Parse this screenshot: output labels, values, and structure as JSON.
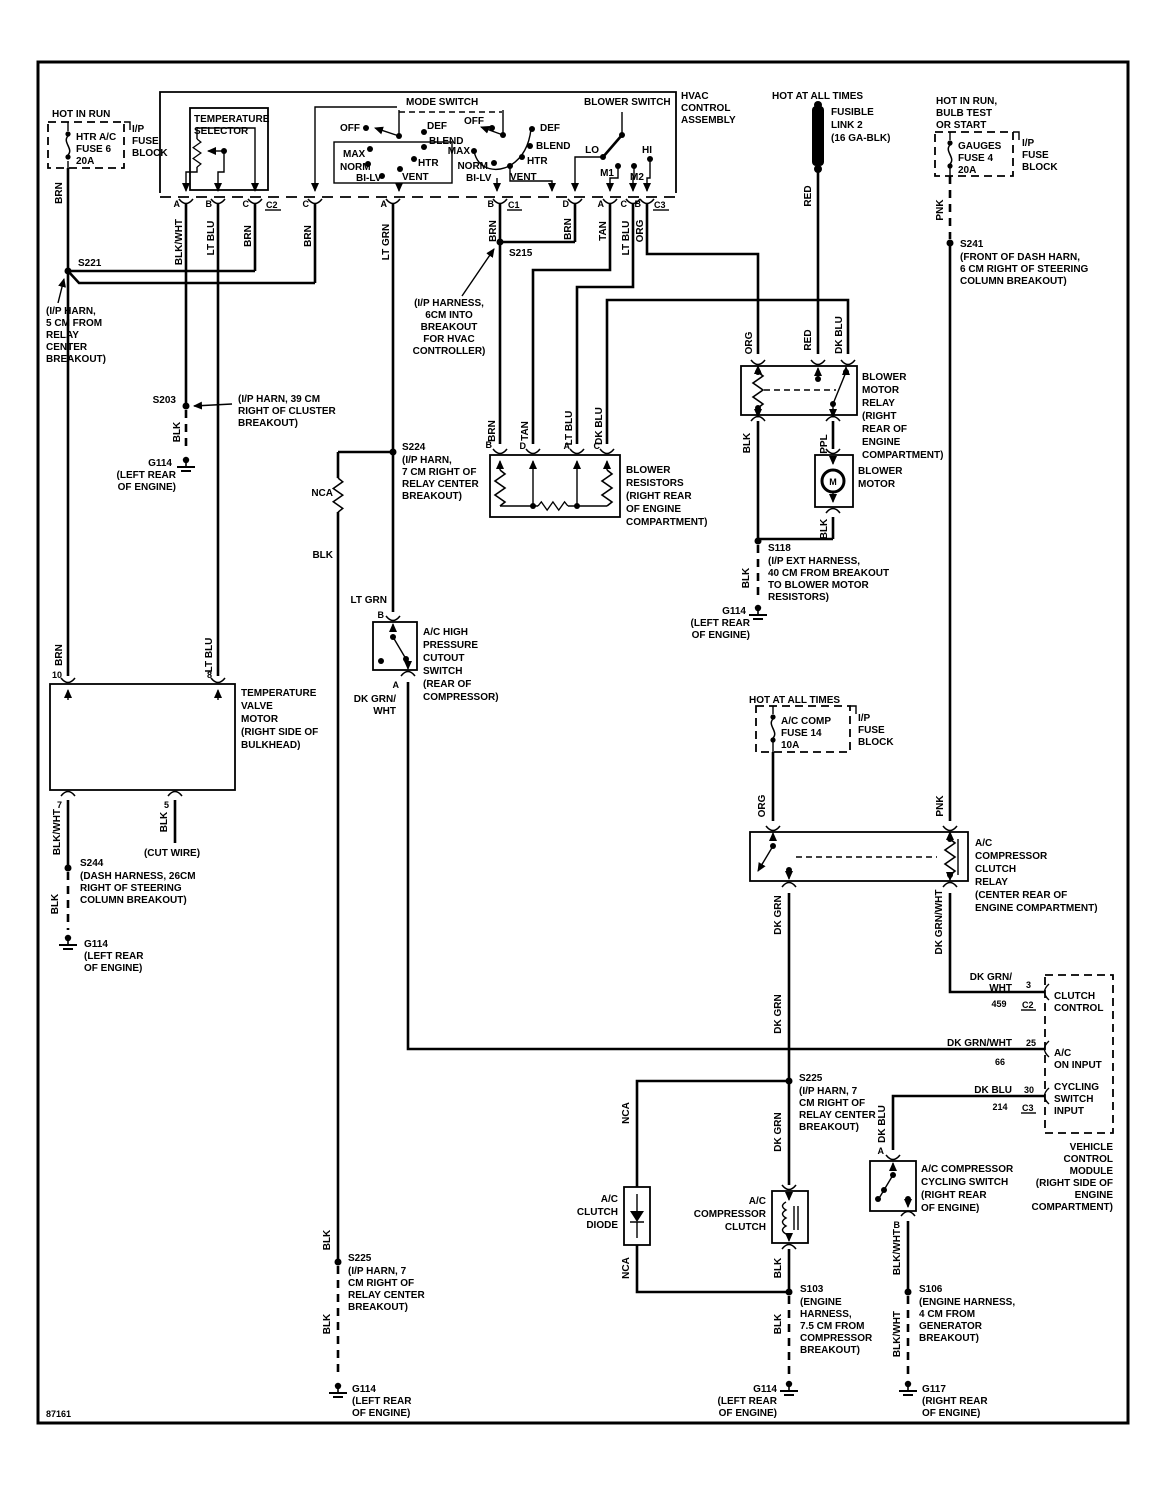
{
  "footer_id": "87161",
  "colors": {
    "ink": "#000000",
    "paper": "#ffffff"
  },
  "wire": {
    "brn": "BRN",
    "blk": "BLK",
    "blkwht": "BLK/WHT",
    "ltblu": "LT BLU",
    "ltgrn": "LT GRN",
    "tan": "TAN",
    "org": "ORG",
    "red": "RED",
    "dkblu": "DK BLU",
    "pnk": "PNK",
    "ppl": "PPL",
    "dkgrn": "DK GRN",
    "dkgrnwht": "DK GRN/WHT",
    "dkgrn_br": "DK GRN/",
    "wht_br": "WHT",
    "nca": "NCA"
  },
  "pin": {
    "a": "A",
    "b": "B",
    "c": "C",
    "d": "D",
    "m": "M",
    "n3": "3",
    "n5": "5",
    "n7": "7",
    "n8": "8",
    "n10": "10",
    "n25": "25",
    "n30": "30",
    "n66": "66",
    "n214": "214",
    "n459": "459",
    "c1": "C1",
    "c2": "C2",
    "c3": "C3"
  },
  "power": {
    "hot_in_run": "HOT IN RUN",
    "hot_at_all_times": "HOT AT ALL TIMES",
    "hot_in_run_bulb_1": "HOT IN RUN,",
    "hot_in_run_bulb_2": "BULB TEST",
    "hot_in_run_bulb_3": "OR START"
  },
  "ip_fuse_block": [
    "I/P",
    "FUSE",
    "BLOCK"
  ],
  "fuse6": [
    "HTR A/C",
    "FUSE 6",
    "20A"
  ],
  "fuse4": [
    "GAUGES",
    "FUSE 4",
    "20A"
  ],
  "fuse14": [
    "A/C COMP",
    "FUSE 14",
    "10A"
  ],
  "fusible_link": [
    "FUSIBLE",
    "LINK 2",
    "(16 GA-BLK)"
  ],
  "hvac": {
    "assembly": [
      "HVAC",
      "CONTROL",
      "ASSEMBLY"
    ],
    "temp_selector": [
      "TEMPERATURE",
      "SELECTOR"
    ],
    "mode_switch": "MODE SWITCH",
    "blower_switch": "BLOWER SWITCH",
    "positions": {
      "off": "OFF",
      "def": "DEF",
      "blend": "BLEND",
      "max": "MAX",
      "norm": "NORM",
      "bilv": "BI-LV",
      "htr": "HTR",
      "vent": "VENT",
      "lo": "LO",
      "hi": "HI",
      "m1": "M1",
      "m2": "M2"
    }
  },
  "temp_valve_motor": [
    "TEMPERATURE",
    "VALVE",
    "MOTOR",
    "(RIGHT SIDE OF",
    "BULKHEAD)"
  ],
  "cut_wire": "(CUT WIRE)",
  "blower_resistors": [
    "BLOWER",
    "RESISTORS",
    "(RIGHT REAR",
    "OF ENGINE",
    "COMPARTMENT)"
  ],
  "blower_motor_relay": [
    "BLOWER",
    "MOTOR",
    "RELAY",
    "(RIGHT",
    "REAR OF",
    "ENGINE",
    "COMPARTMENT)"
  ],
  "blower_motor": [
    "BLOWER",
    "MOTOR"
  ],
  "hp_cutout_switch": [
    "A/C HIGH",
    "PRESSURE",
    "CUTOUT",
    "SWITCH",
    "(REAR OF",
    "COMPRESSOR)"
  ],
  "ac_relay": [
    "A/C",
    "COMPRESSOR",
    "CLUTCH",
    "RELAY",
    "(CENTER REAR OF",
    "ENGINE COMPARTMENT)"
  ],
  "ac_clutch_diode": [
    "A/C",
    "CLUTCH",
    "DIODE"
  ],
  "ac_clutch": [
    "A/C",
    "COMPRESSOR",
    "CLUTCH"
  ],
  "cycling_switch": [
    "A/C COMPRESSOR",
    "CYCLING SWITCH",
    "(RIGHT REAR",
    "OF ENGINE)"
  ],
  "vcm": {
    "clutch_control": [
      "CLUTCH",
      "CONTROL"
    ],
    "ac_on_input": [
      "A/C",
      "ON INPUT"
    ],
    "cycling_input": [
      "CYCLING",
      "SWITCH",
      "INPUT"
    ],
    "label": [
      "VEHICLE",
      "CONTROL",
      "MODULE",
      "(RIGHT SIDE OF",
      "ENGINE",
      "COMPARTMENT)"
    ]
  },
  "splice": {
    "s221": {
      "id": "S221",
      "note": [
        "(I/P HARN,",
        "5 CM FROM",
        "RELAY",
        "CENTER",
        "BREAKOUT)"
      ]
    },
    "s203": {
      "id": "S203",
      "note": [
        "(I/P HARN, 39 CM",
        "RIGHT OF CLUSTER",
        "BREAKOUT)"
      ]
    },
    "s215": {
      "id": "S215",
      "note": [
        "(I/P HARNESS,",
        "6CM INTO",
        "BREAKOUT",
        "FOR HVAC",
        "CONTROLLER)"
      ]
    },
    "s224": {
      "id": "S224",
      "note": [
        "(I/P HARN,",
        "7 CM RIGHT OF",
        "RELAY CENTER",
        "BREAKOUT)"
      ]
    },
    "s225": {
      "id": "S225",
      "note": [
        "(I/P HARN, 7",
        "CM RIGHT OF",
        "RELAY CENTER",
        "BREAKOUT)"
      ]
    },
    "s241": {
      "id": "S241",
      "note": [
        "(FRONT OF DASH HARN,",
        "6 CM RIGHT OF STEERING",
        "COLUMN BREAKOUT)"
      ]
    },
    "s244": {
      "id": "S244",
      "note": [
        "(DASH HARNESS, 26CM",
        "RIGHT OF STEERING",
        "COLUMN BREAKOUT)"
      ]
    },
    "s118": {
      "id": "S118",
      "note": [
        "(I/P EXT HARNESS,",
        "40 CM FROM BREAKOUT",
        "TO BLOWER MOTOR",
        "RESISTORS)"
      ]
    },
    "s103": {
      "id": "S103",
      "note": [
        "(ENGINE",
        "HARNESS,",
        "7.5 CM FROM",
        "COMPRESSOR",
        "BREAKOUT)"
      ]
    },
    "s106": {
      "id": "S106",
      "note": [
        "(ENGINE HARNESS,",
        "4 CM FROM",
        "GENERATOR",
        "BREAKOUT)"
      ]
    }
  },
  "ground": {
    "g114": {
      "id": "G114",
      "note": [
        "(LEFT REAR",
        "OF ENGINE)"
      ]
    },
    "g117": {
      "id": "G117",
      "note": [
        "(RIGHT REAR",
        "OF ENGINE)"
      ]
    }
  }
}
